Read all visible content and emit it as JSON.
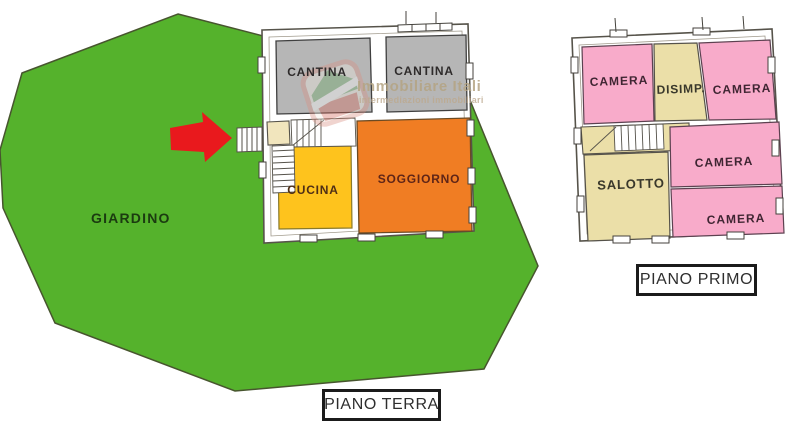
{
  "colors": {
    "garden_green": "#55b22c",
    "cantina_gray": "#b6b6b6",
    "cucina_yellow": "#fec31d",
    "soggiorno_orange": "#f07d23",
    "camera_pink": "#f8abca",
    "service_beige": "#ebdfa8",
    "entry_beige": "#f1e5bd",
    "arrow_red": "#e9191d",
    "white": "#ffffff"
  },
  "garden": {
    "label": "GIARDINO"
  },
  "watermark": {
    "brand": "Immobiliare Itali",
    "tagline": "intermediazioni immobiliari"
  },
  "ground_floor": {
    "caption": "PIANO TERRA",
    "rooms": [
      {
        "label": "CANTINA"
      },
      {
        "label": "CANTINA"
      },
      {
        "label": "CUCINA"
      },
      {
        "label": "SOGGIORNO"
      }
    ]
  },
  "first_floor": {
    "caption": "PIANO PRIMO",
    "rooms": [
      {
        "label": "CAMERA"
      },
      {
        "label": "DISIMP."
      },
      {
        "label": "CAMERA"
      },
      {
        "label": "SALOTTO"
      },
      {
        "label": "CAMERA"
      },
      {
        "label": "CAMERA"
      }
    ]
  }
}
